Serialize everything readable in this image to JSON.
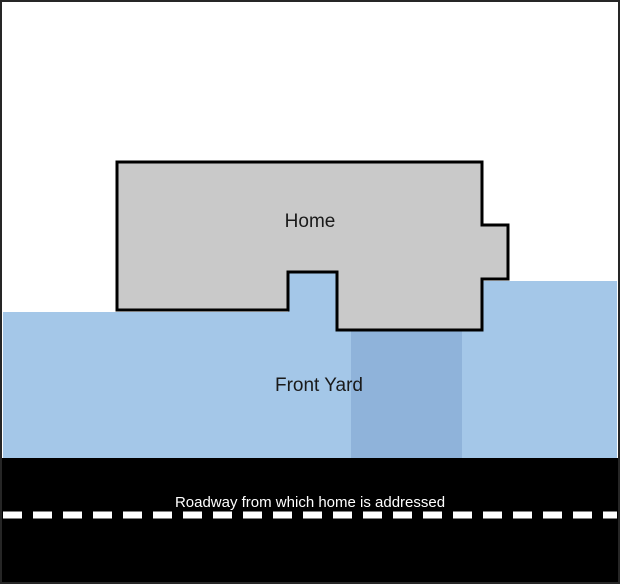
{
  "diagram": {
    "background_color": "#FFFFFF",
    "border_color": "#262626",
    "home": {
      "label": "Home",
      "fill": "#C9C9C9",
      "border_color": "#000000"
    },
    "front_yard": {
      "label": "Front Yard",
      "fill": "#A4C7E8"
    },
    "driveway": {
      "fill": "#8FB3DA"
    },
    "roadway": {
      "label": "Roadway from which home is addressed",
      "fill": "#000000",
      "label_color": "#FFFFFF",
      "center_line_color": "#FFFFFF"
    }
  }
}
